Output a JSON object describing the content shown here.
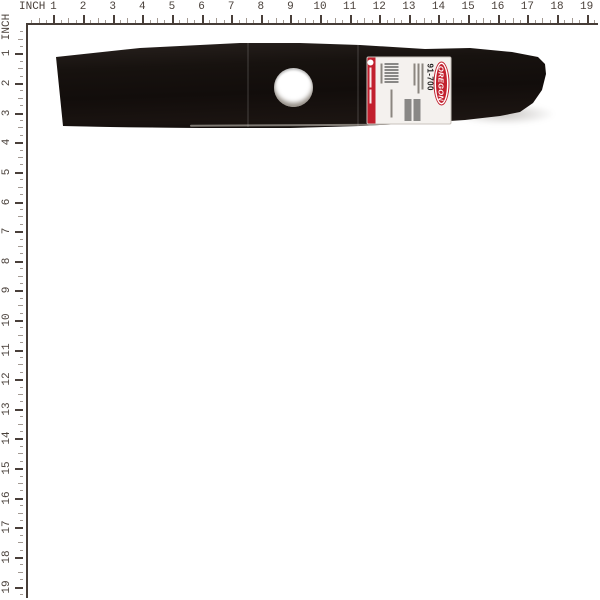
{
  "ruler": {
    "unit_label": "INCH",
    "numbers": [
      "1",
      "2",
      "3",
      "4",
      "5",
      "6",
      "7",
      "8",
      "9",
      "10",
      "11",
      "12",
      "13",
      "14",
      "15",
      "16",
      "17",
      "18",
      "19"
    ],
    "line_color": "#463d37",
    "major_tick_color": "#4a403a",
    "minor_tick_color": "#a39a93",
    "number_color": "#4a413b"
  },
  "product": {
    "label": {
      "brand": "OREGON",
      "part_number": "91-700",
      "brand_color": "#c2202e",
      "strip_color": "#c2202e"
    },
    "blade_color": "#17120f"
  }
}
